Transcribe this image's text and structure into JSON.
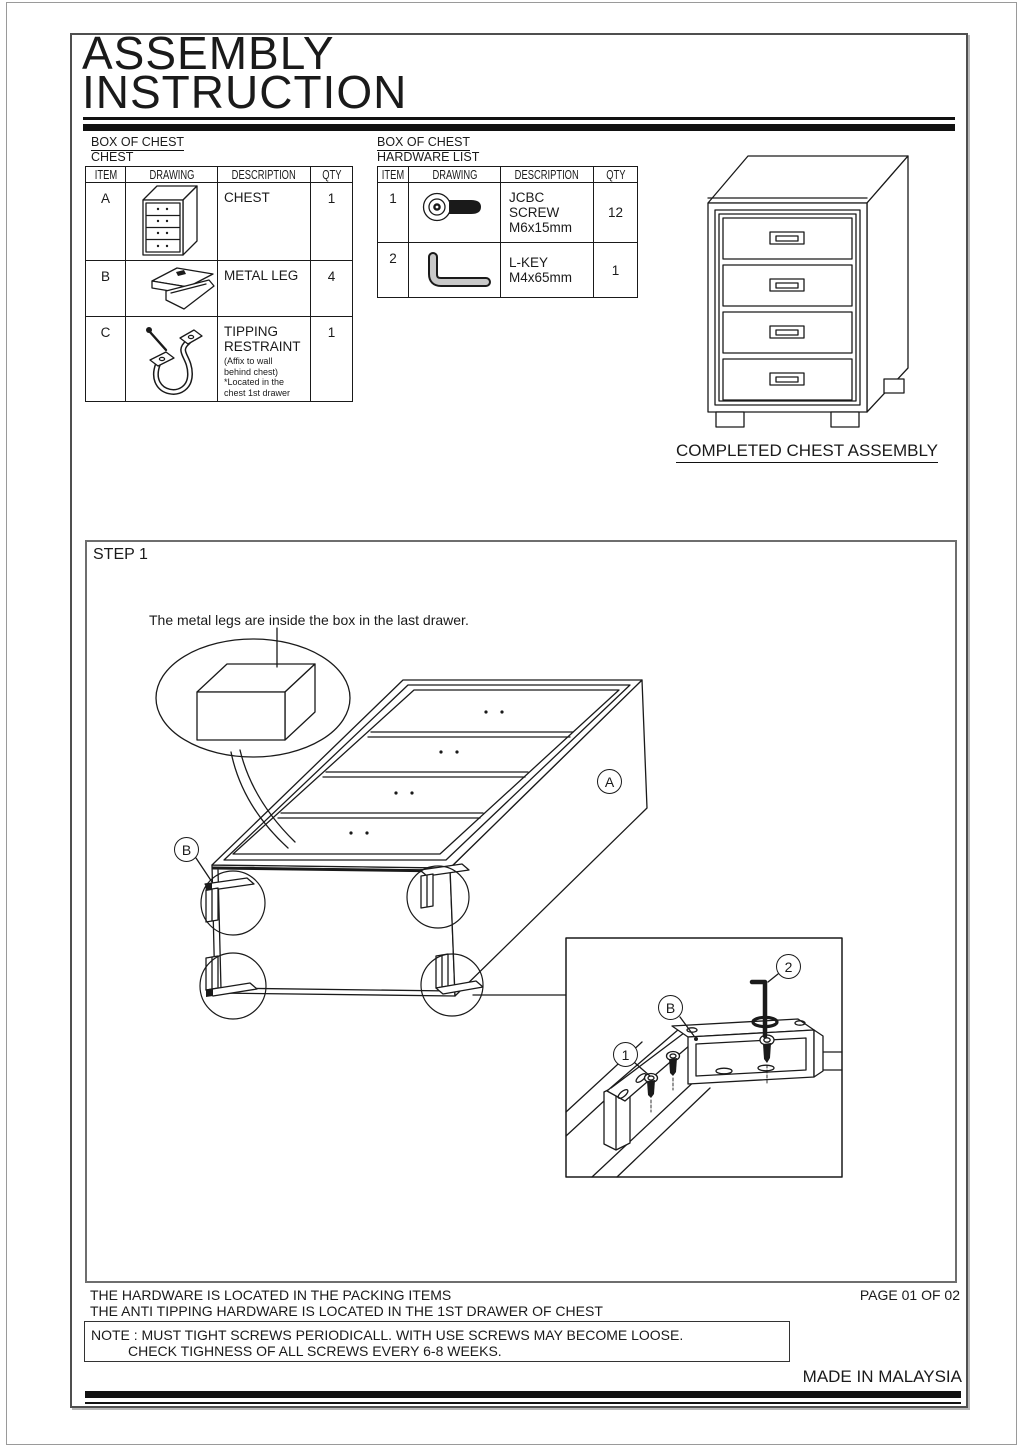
{
  "title": {
    "line1": "ASSEMBLY",
    "line2": "INSTRUCTION"
  },
  "parts_table": {
    "label_line1": "BOX OF CHEST",
    "label_line2": "CHEST",
    "headers": [
      "ITEM",
      "DRAWING",
      "DESCRIPTION",
      "QTY"
    ],
    "rows": [
      {
        "item": "A",
        "drawing": "chest-drawing",
        "description": "CHEST",
        "note": "",
        "qty": "1"
      },
      {
        "item": "B",
        "drawing": "metal-leg-drawing",
        "description": "METAL LEG",
        "note": "",
        "qty": "4"
      },
      {
        "item": "C",
        "drawing": "tipping-restraint-drawing",
        "description": "TIPPING RESTRAINT",
        "note": "(Affix to wall\nbehind chest)\n*Located in the\nchest 1st drawer",
        "qty": "1"
      }
    ]
  },
  "hardware_table": {
    "label_line1": "BOX OF CHEST",
    "label_line2": "HARDWARE LIST",
    "headers": [
      "ITEM",
      "DRAWING",
      "DESCRIPTION",
      "QTY"
    ],
    "rows": [
      {
        "item": "1",
        "drawing": "jcbc-screw-drawing",
        "description": "JCBC SCREW\nM6x15mm",
        "qty": "12"
      },
      {
        "item": "2",
        "drawing": "l-key-drawing",
        "description": "L-KEY\nM4x65mm",
        "qty": "1"
      }
    ]
  },
  "completed_assembly": {
    "caption": "COMPLETED CHEST ASSEMBLY"
  },
  "step1": {
    "label": "STEP 1",
    "caption": "The metal legs are inside the box in the last drawer.",
    "callouts": {
      "chest": "A",
      "leg": "B",
      "inset_leg": "B",
      "inset_screw": "1",
      "inset_lkey": "2"
    }
  },
  "footer": {
    "hardware_location": "THE HARDWARE IS LOCATED IN THE PACKING ITEMS",
    "page": "PAGE 01 OF 02",
    "anti_tipping_location": "THE ANTI TIPPING HARDWARE IS LOCATED IN THE 1ST DRAWER OF CHEST",
    "note_line1": "NOTE : MUST TIGHT SCREWS PERIODICALL. WITH USE SCREWS MAY BECOME LOOSE.",
    "note_line2": "CHECK TIGHNESS OF ALL SCREWS EVERY 6-8 WEEKS.",
    "origin": "MADE IN MALAYSIA"
  },
  "colors": {
    "line": "#1a1a1a",
    "frame_border": "#4f4f4f",
    "step_border": "#6e6e6e"
  }
}
